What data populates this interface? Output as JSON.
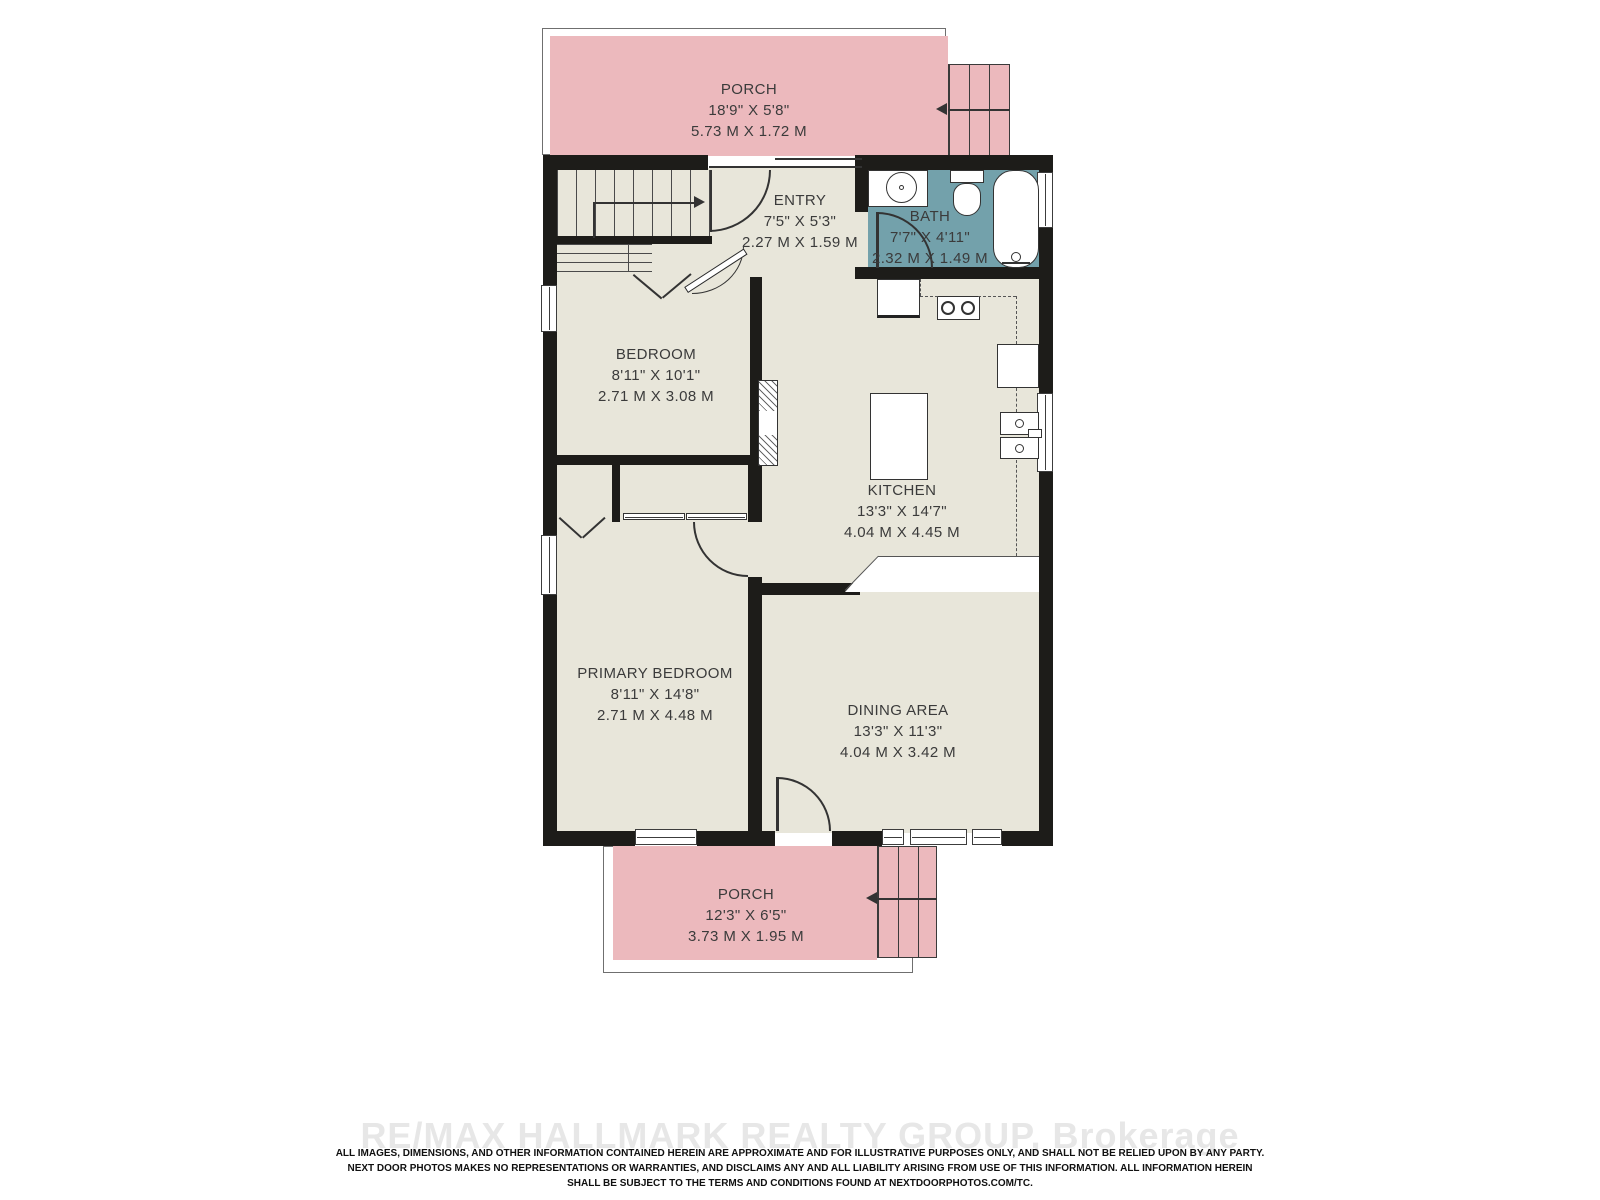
{
  "rooms": {
    "porch_top": {
      "name": "PORCH",
      "imperial": "18'9\" X 5'8\"",
      "metric": "5.73 M X 1.72 M"
    },
    "entry": {
      "name": "ENTRY",
      "imperial": "7'5\" X 5'3\"",
      "metric": "2.27 M X 1.59 M"
    },
    "bath": {
      "name": "BATH",
      "imperial": "7'7\" X 4'11\"",
      "metric": "2.32 M X 1.49 M"
    },
    "bedroom": {
      "name": "BEDROOM",
      "imperial": "8'11\" X 10'1\"",
      "metric": "2.71 M X 3.08 M"
    },
    "kitchen": {
      "name": "KITCHEN",
      "imperial": "13'3\" X 14'7\"",
      "metric": "4.04 M X 4.45 M"
    },
    "primary_bedroom": {
      "name": "PRIMARY BEDROOM",
      "imperial": "8'11\" X 14'8\"",
      "metric": "2.71 M X 4.48 M"
    },
    "dining": {
      "name": "DINING AREA",
      "imperial": "13'3\" X 11'3\"",
      "metric": "4.04 M X 3.42 M"
    },
    "porch_bottom": {
      "name": "PORCH",
      "imperial": "12'3\" X 6'5\"",
      "metric": "3.73 M X 1.95 M"
    }
  },
  "footer": {
    "watermark": "RE/MAX HALLMARK REALTY GROUP, Brokerage",
    "disclaimer_line1": "ALL IMAGES, DIMENSIONS, AND OTHER INFORMATION CONTAINED HEREIN ARE APPROXIMATE AND FOR ILLUSTRATIVE PURPOSES ONLY, AND SHALL NOT BE RELIED UPON BY ANY PARTY.",
    "disclaimer_line2": "NEXT DOOR PHOTOS MAKES NO REPRESENTATIONS OR WARRANTIES, AND DISCLAIMS ANY AND ALL LIABILITY ARISING FROM USE OF THIS INFORMATION. ALL INFORMATION HEREIN",
    "disclaimer_line3": "SHALL BE SUBJECT TO THE TERMS AND CONDITIONS FOUND AT NEXTDOORPHOTOS.COM/TC."
  },
  "colors": {
    "wall": "#1d1c19",
    "floor": "#e8e6da",
    "porch": "#ecb9bd",
    "bath": "#73a1ab",
    "label_text": "#3b3b3b",
    "watermark": "#e7e7e7"
  }
}
